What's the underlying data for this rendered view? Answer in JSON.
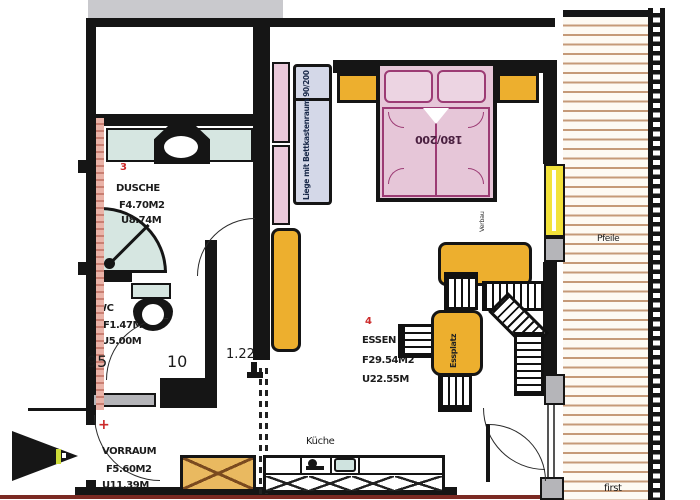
{
  "plan": {
    "rooms": {
      "dusche": {
        "number": "3",
        "name": "DUSCHE",
        "area": "F4.70M2",
        "perimeter": "U8.74M"
      },
      "wc": {
        "name": "WC",
        "area": "F1.47M2",
        "perimeter": "U5.00M"
      },
      "vorraum": {
        "name": "VORRAUM",
        "area": "F5.60M2",
        "perimeter": "U11.39M"
      },
      "essen": {
        "number": "4",
        "name": "ESSEN U.",
        "area": "F29.54M2",
        "perimeter": "U22.55M"
      },
      "kueche": {
        "name": "Küche"
      }
    },
    "furniture": {
      "bed_label": "180/200",
      "liege_label": "Liege mit Bettkastenraum 90/200",
      "essplatz_label": "Essplatz",
      "bed_side_note": "Verbau"
    },
    "dimensions": {
      "wc_door_width": "95",
      "wall_thickness": "10",
      "opening_width": "1.22"
    },
    "balcony": {
      "label": "Pfeile",
      "bottom_label": "first"
    },
    "marks": {
      "survey_cross": "+"
    },
    "colors": {
      "wall": "#151515",
      "furniture_orange": "#edaf2e",
      "bed_pink": "#e6c6d8",
      "bed_line": "#9c3b74",
      "liege_lavender": "#d4d8e8",
      "shelf_pink": "#eac9da",
      "fixture_cyan": "#d6e6e1",
      "window_yellow": "#f2e23a",
      "door_gray": "#b5b5b9",
      "deck_stripe": "#c59a78",
      "bottom_line_maroon": "#7b2a23",
      "room_number_red": "#cc2a2a",
      "entry_mark_lime": "#cddc39"
    }
  }
}
